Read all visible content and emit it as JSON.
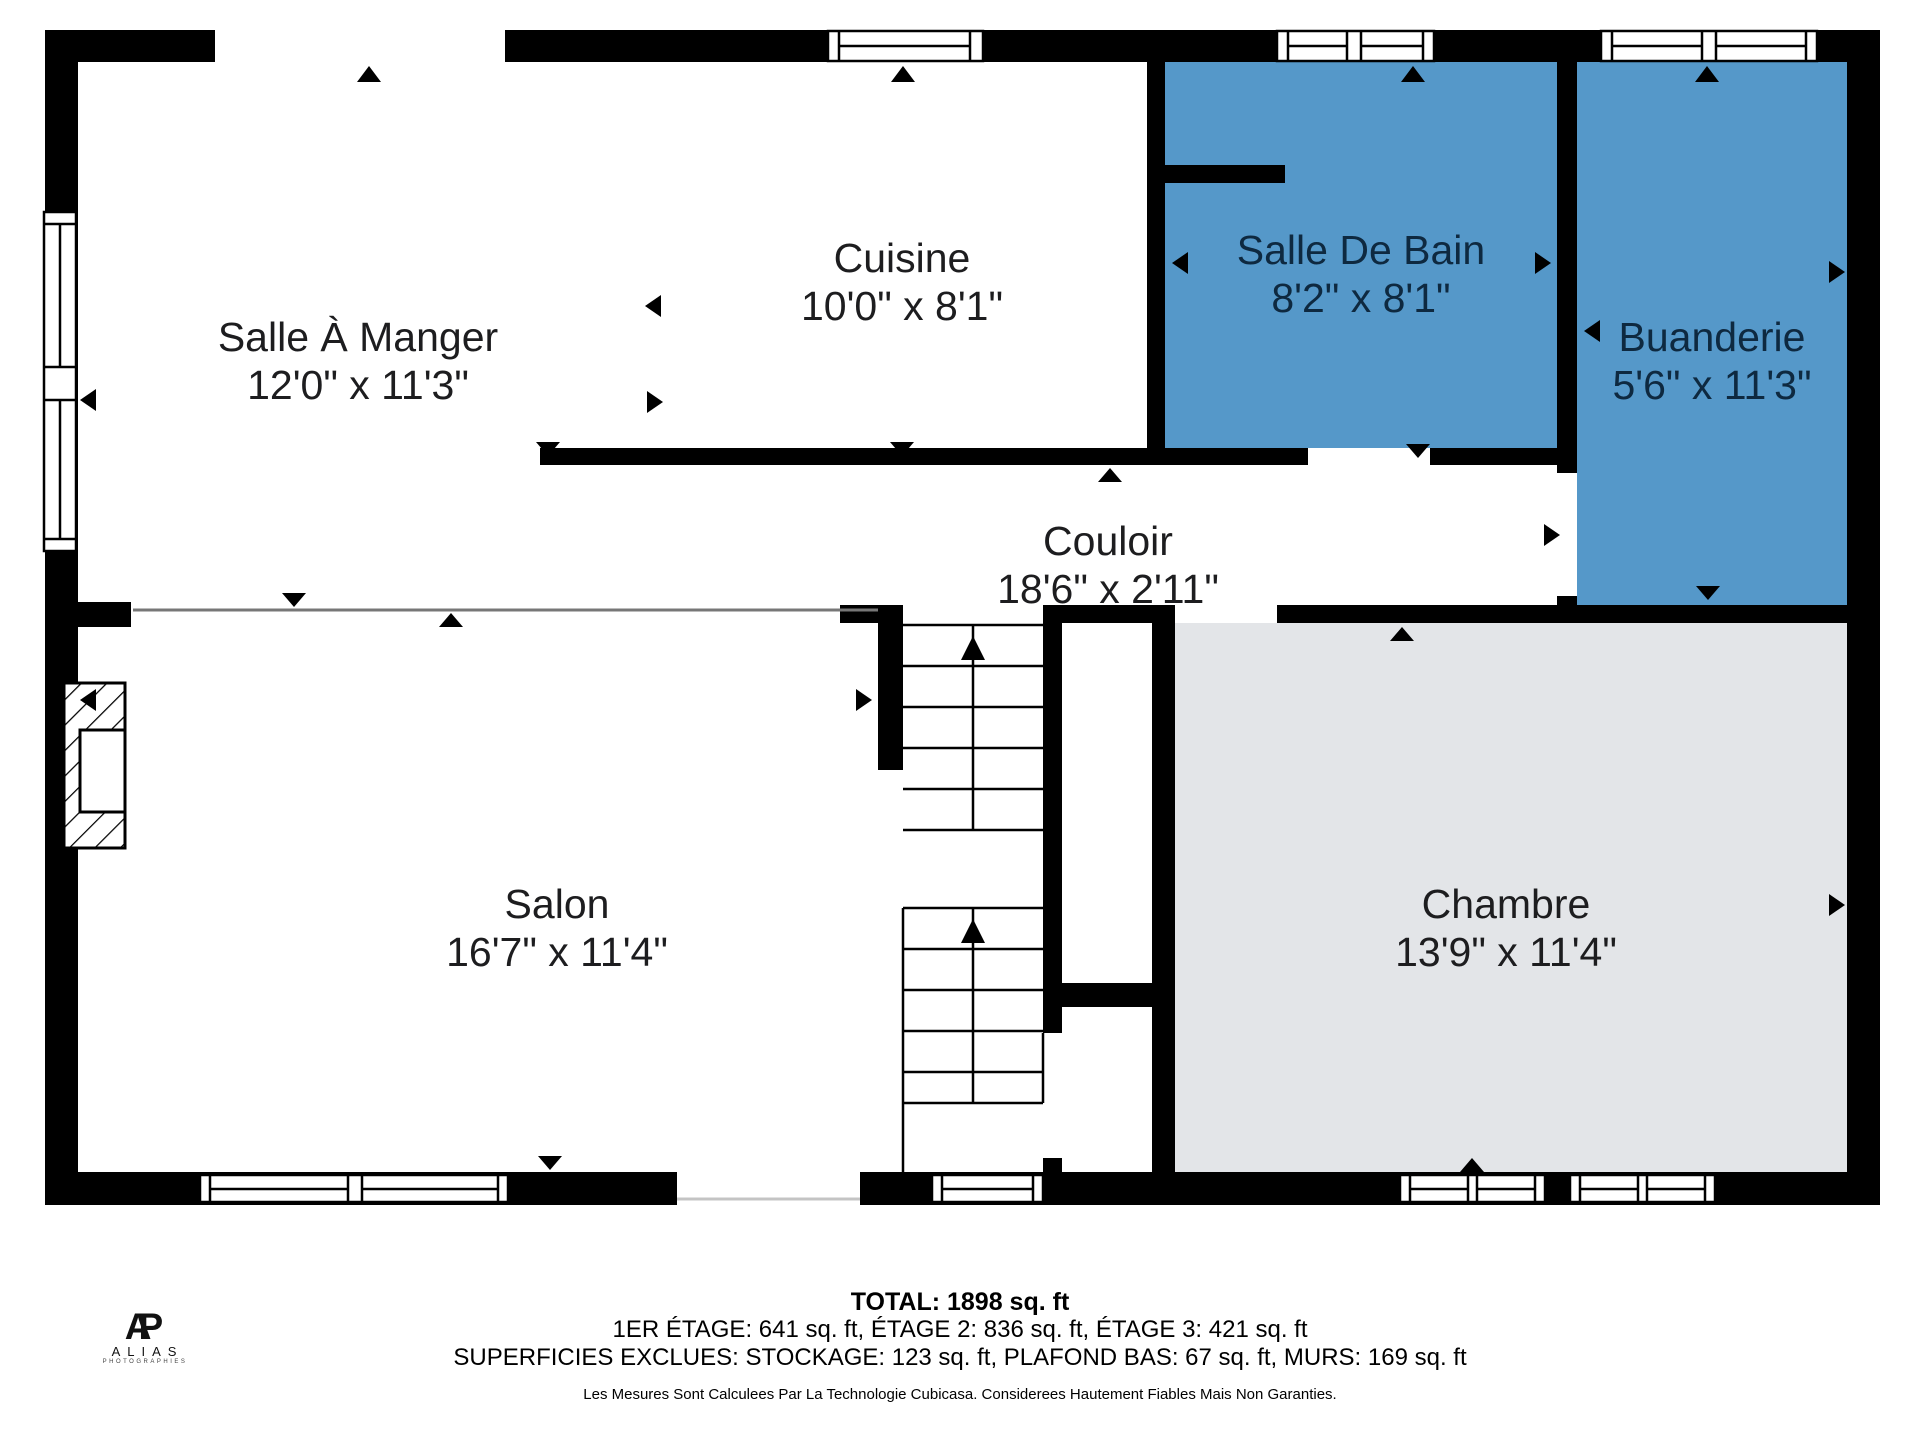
{
  "plan": {
    "rooms": [
      {
        "name": "Salle À Manger",
        "dims": "12'0\" x 11'3\"",
        "floor": "white"
      },
      {
        "name": "Cuisine",
        "dims": "10'0\" x 8'1\"",
        "floor": "white"
      },
      {
        "name": "Salle De Bain",
        "dims": "8'2\" x 8'1\"",
        "floor": "wet"
      },
      {
        "name": "Buanderie",
        "dims": "5'6\" x 11'3\"",
        "floor": "wet"
      },
      {
        "name": "Couloir",
        "dims": "18'6\" x 2'11\"",
        "floor": "white"
      },
      {
        "name": "Salon",
        "dims": "16'7\" x 11'4\"",
        "floor": "white"
      },
      {
        "name": "Chambre",
        "dims": "13'9\" x 11'4\"",
        "floor": "bedroom"
      }
    ],
    "colors": {
      "wet_room": "#5598c9",
      "bedroom": "#e3e5e8",
      "wall": "#000000",
      "label_dark": "#0e2940",
      "label": "#1d1d1f"
    }
  },
  "footer": {
    "total": "TOTAL: 1898 sq. ft",
    "floors": "1ER ÉTAGE: 641 sq. ft, ÉTAGE 2: 836 sq. ft, ÉTAGE 3: 421 sq. ft",
    "exclusions": "SUPERFICIES EXCLUES: STOCKAGE: 123 sq. ft, PLAFOND BAS: 67 sq. ft, MURS: 169 sq. ft",
    "disclaimer": "Les Mesures Sont Calculees Par La Technologie Cubicasa. Considerees Hautement Fiables Mais Non Garanties."
  },
  "logo": {
    "monogram_a": "A",
    "monogram_p": "P",
    "name": "ALIAS",
    "subtitle": "PHOTOGRAPHIES"
  }
}
